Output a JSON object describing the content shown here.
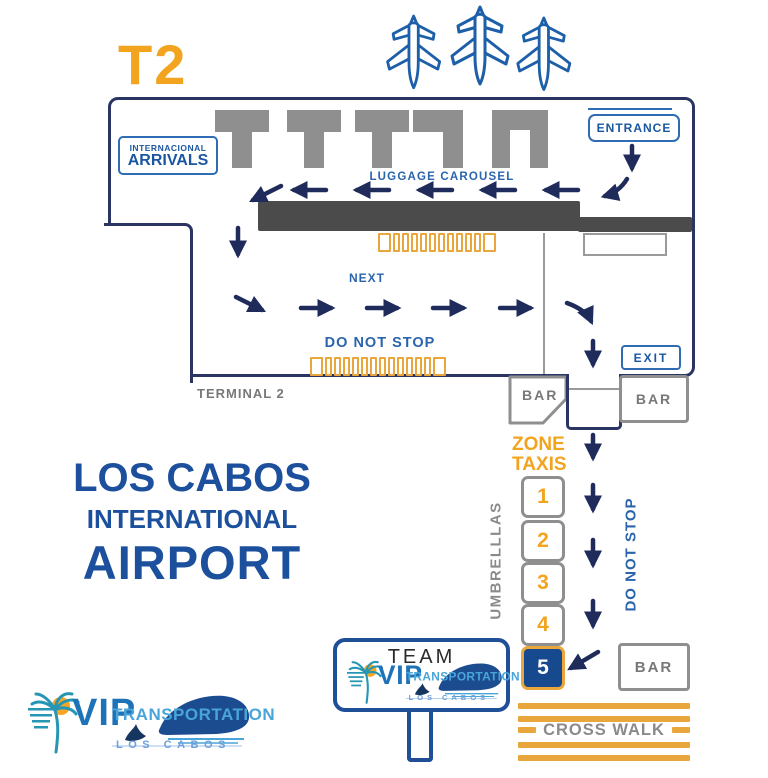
{
  "header": {
    "terminal_code": "T2"
  },
  "terminal": {
    "arrivals_box": {
      "line1": "INTERNACIONAL",
      "line2": "ARRIVALS"
    },
    "entrance_label": "ENTRANCE",
    "luggage_carousel_label": "LUGGAGE CAROUSEL",
    "next_label": "NEXT",
    "do_not_stop_label": "DO NOT STOP",
    "exit_label": "EXIT",
    "bar_left_label": "BAR",
    "bar_right_label": "BAR",
    "terminal_caption": "TERMINAL 2"
  },
  "curbside": {
    "zone_taxis": {
      "line1": "ZONE",
      "line2": "TAXIS"
    },
    "taxi_stands": [
      {
        "number": "1",
        "highlighted": false
      },
      {
        "number": "2",
        "highlighted": false
      },
      {
        "number": "3",
        "highlighted": false
      },
      {
        "number": "4",
        "highlighted": false
      },
      {
        "number": "5",
        "highlighted": true
      }
    ],
    "umbrellas_label": "UMBRELLLAS",
    "do_not_stop_vertical": "DO NOT STOP",
    "bar_label": "BAR",
    "crosswalk_label": "CROSS WALK",
    "team_sign": {
      "title": "TEAM"
    }
  },
  "branding": {
    "airport_name": {
      "line1": "LOS CABOS",
      "line2": "INTERNATIONAL",
      "line3": "AIRPORT"
    },
    "vip_logo": {
      "vip": "VIP",
      "transportation": "TRANSPORTATION",
      "los_cabos": "LOS CABOS"
    }
  },
  "colors": {
    "orange": "#F2A41F",
    "barrier_orange": "#E9A63C",
    "arrow_navy": "#1F2B5B",
    "outline_navy": "#2A3563",
    "label_blue": "#2A64AD",
    "box_border_blue": "#2F6CB3",
    "airport_blue": "#1C4F9C",
    "structure_gray": "#8F8F8F",
    "carousel_gray": "#4B4B4B",
    "zone5_fill": "#17498F",
    "logo_blue": "#1D72B8",
    "logo_light_blue": "#49A5D9",
    "logo_teal": "#2796B5"
  }
}
